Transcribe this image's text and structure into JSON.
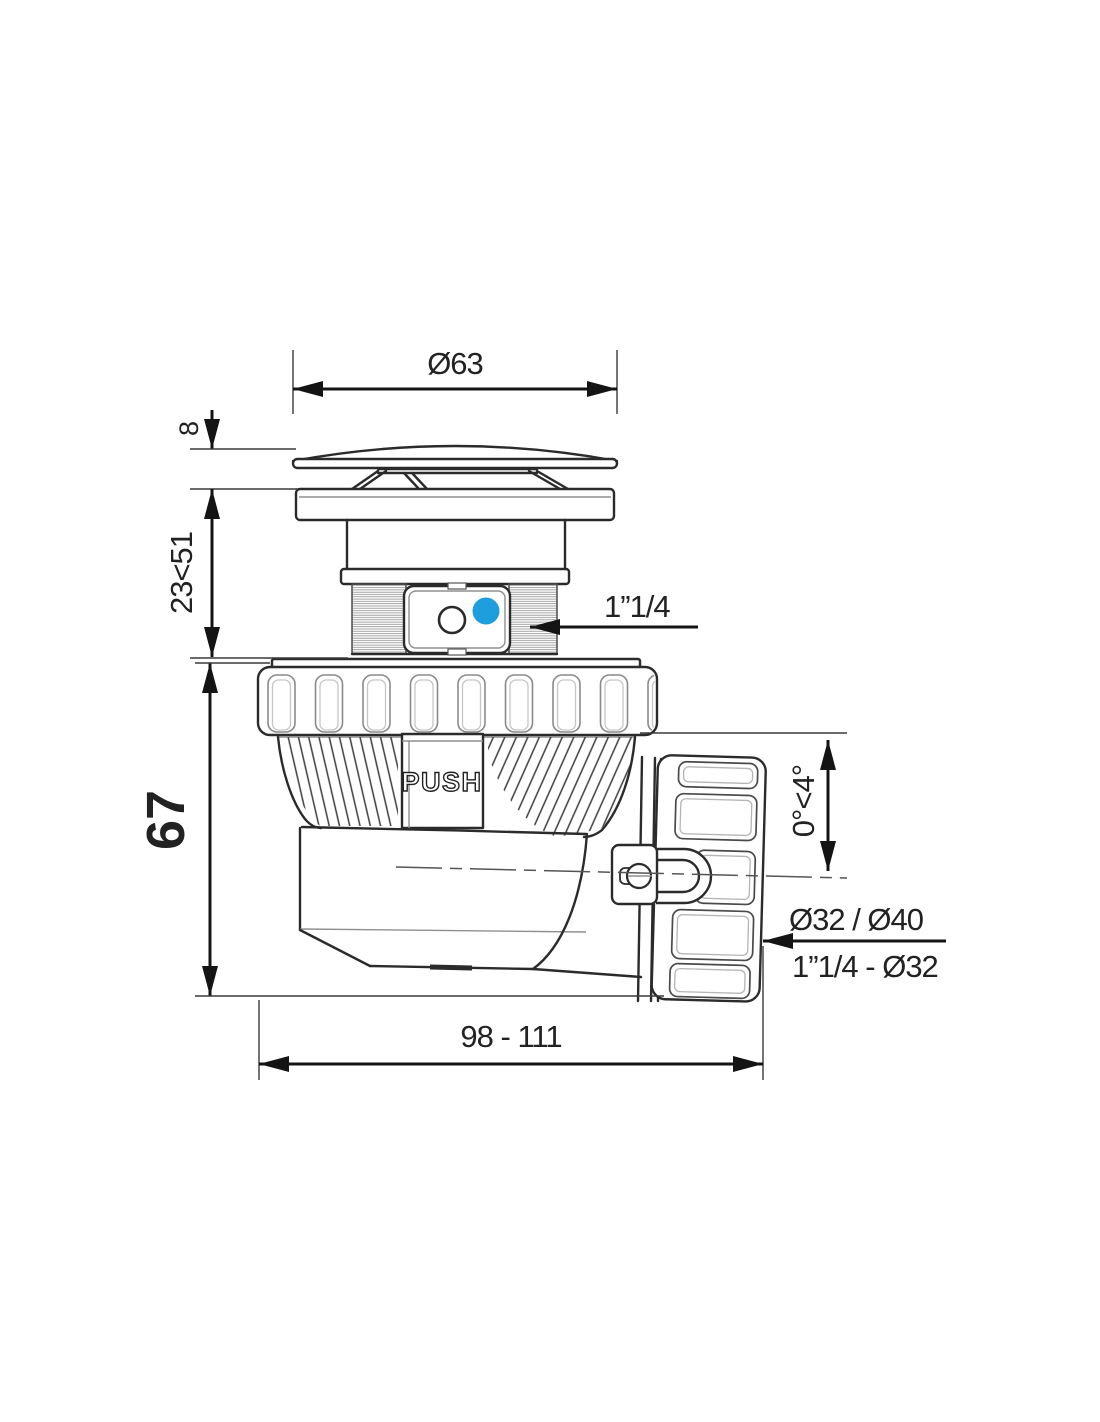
{
  "drawing": {
    "dimensions": {
      "cap_diameter": "Ø63",
      "cap_height": "8",
      "clamp_range": "23<51",
      "body_height": "67",
      "inlet_thread": "1”1/4",
      "tilt_angle": "0°<4°",
      "outlet_sizes": "Ø32 / Ø40",
      "outlet_thread": "1”1/4 - Ø32",
      "overall_length": "98 - 111"
    },
    "labels": {
      "push": "PUSH"
    },
    "colors": {
      "line": "#2b2b2b",
      "dimension": "#141414",
      "accent_blue": "#1E9EDC",
      "detail_gray": "#8f8f8f",
      "background": "#ffffff"
    }
  }
}
